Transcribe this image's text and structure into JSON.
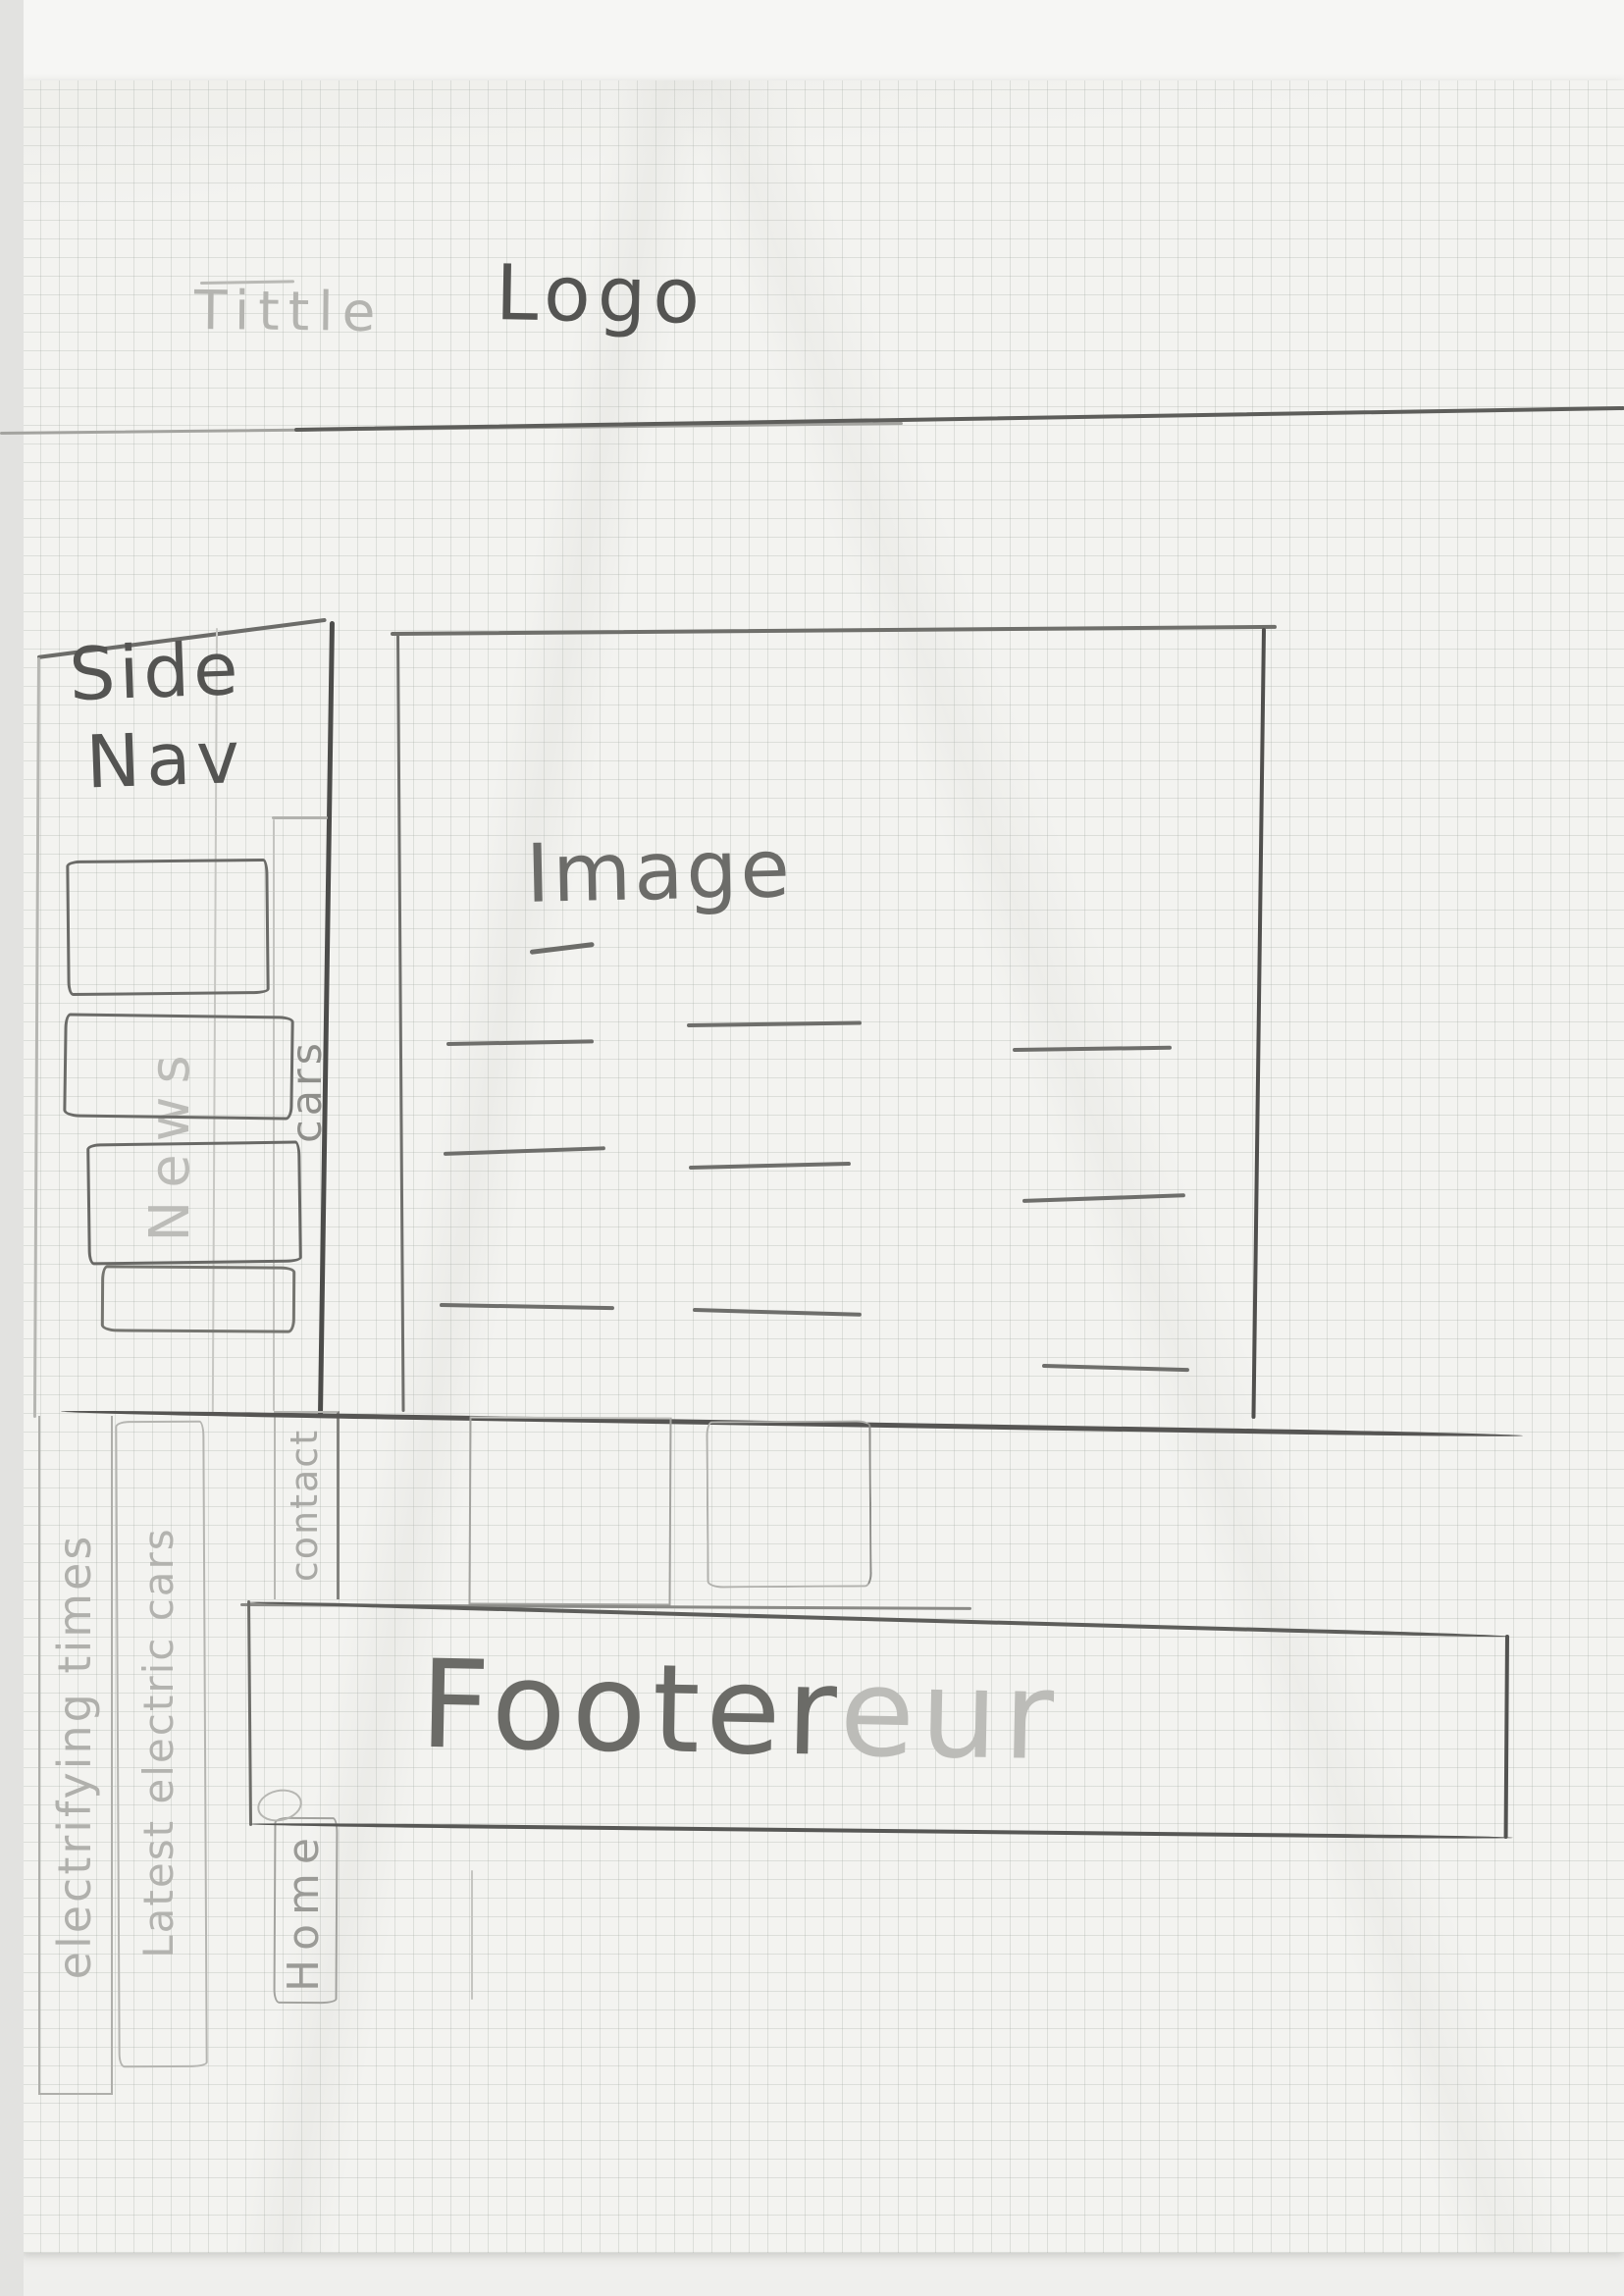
{
  "medium": "hand-drawn website wireframe sketch on graph paper",
  "header": {
    "title_label": "Tittle",
    "logo_label": "Logo"
  },
  "sidebar": {
    "heading_line1": "Side",
    "heading_line2": "Nav",
    "faint_label": "News"
  },
  "nav_strip": {
    "labels": [
      "cars",
      "contact",
      "Home"
    ]
  },
  "rotated_notes": [
    "electrifying times",
    "Latest electric cars"
  ],
  "main": {
    "image_label": "Image"
  },
  "footer": {
    "label": "Footer",
    "faint_suffix": "eur"
  },
  "colors": {
    "paper": "#f3f3f0",
    "grid_line": "#d7d9d6",
    "pencil_dark": "#4f4f4c",
    "pencil_mid": "#6c6c69",
    "pencil_light": "#979793",
    "pencil_faint": "#b4b4b0"
  }
}
